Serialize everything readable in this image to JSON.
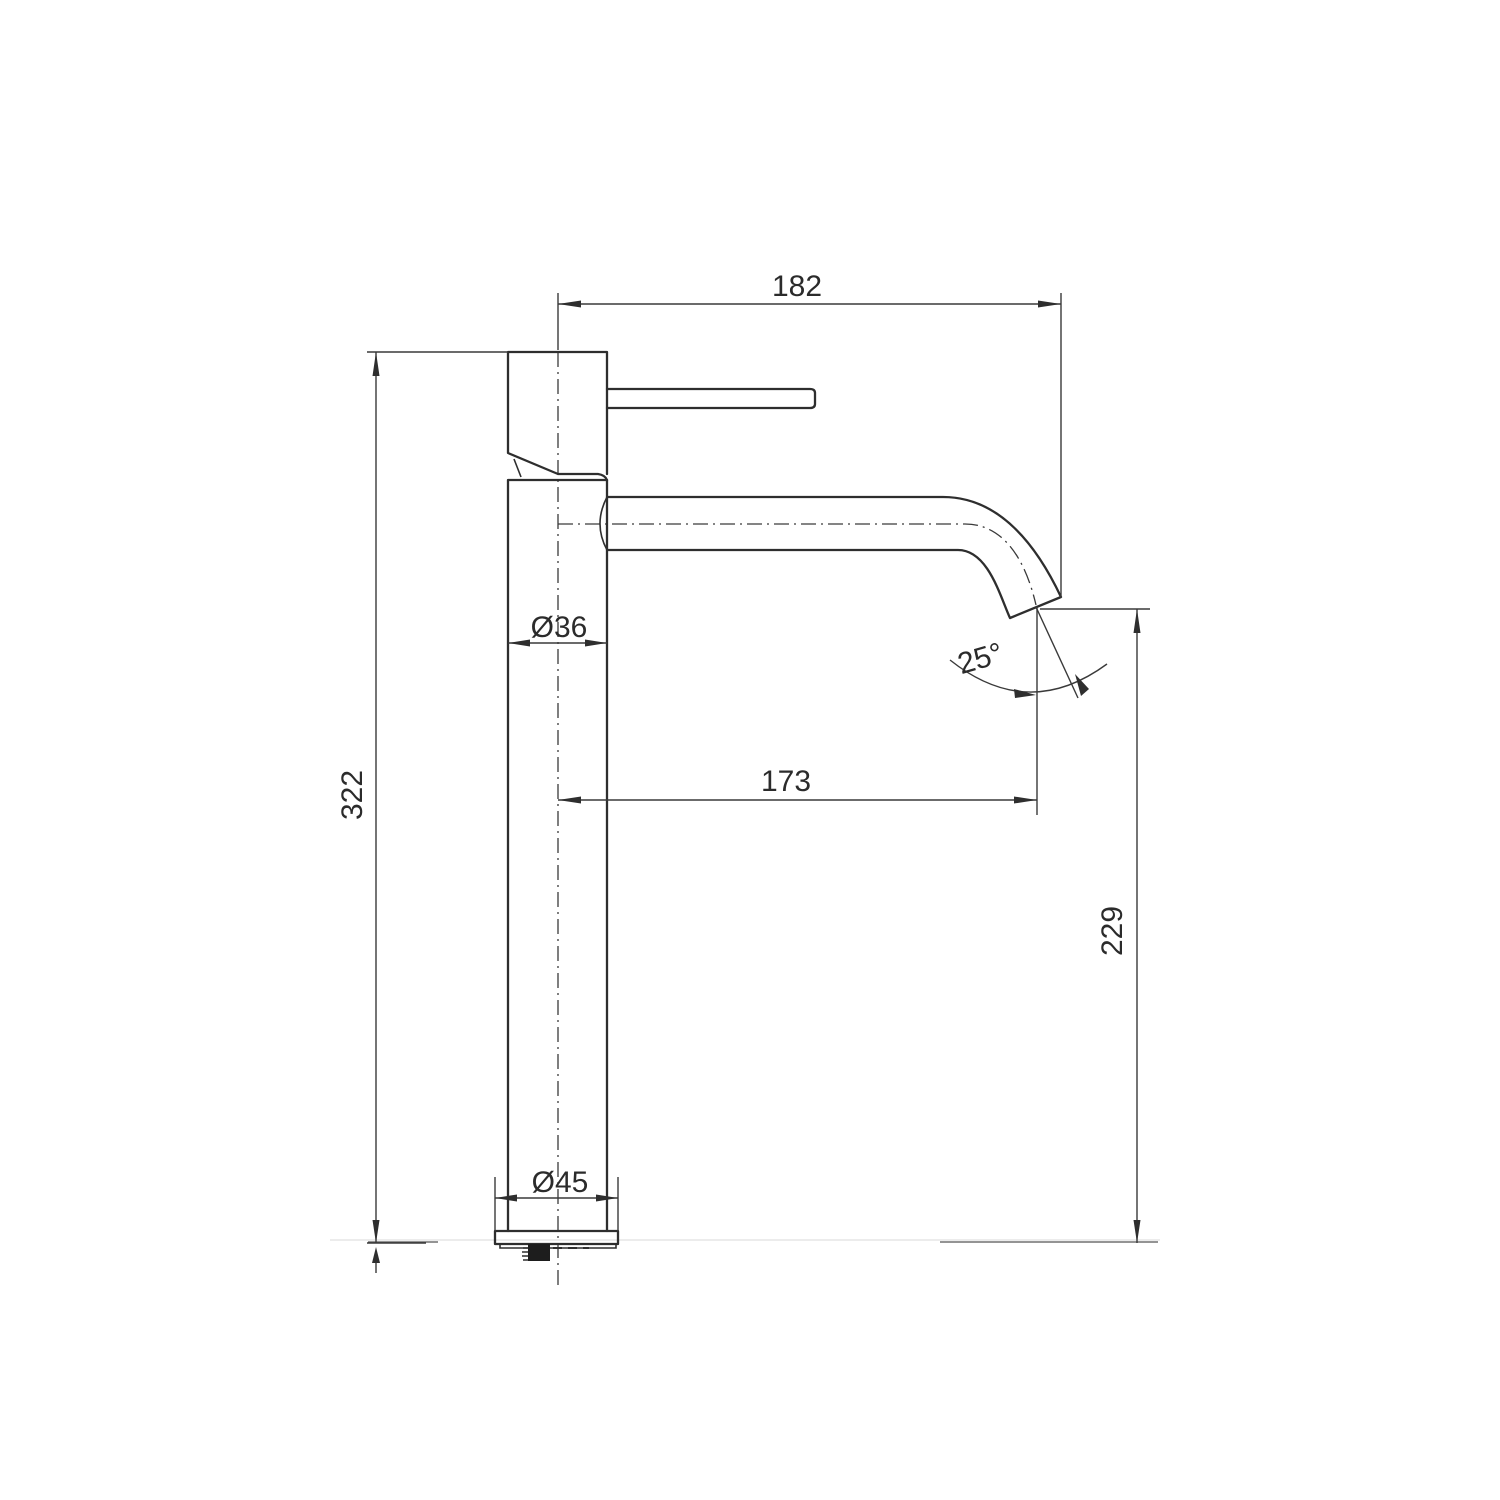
{
  "figure": {
    "background": "#ffffff",
    "line_color": "#2e2e2e",
    "labels": {
      "reach_overall": "182",
      "body_diameter": "Ø36",
      "height_overall": "322",
      "reach_to_outlet": "173",
      "spout_angle": "25°",
      "outlet_height": "229",
      "base_diameter": "Ø45"
    }
  }
}
